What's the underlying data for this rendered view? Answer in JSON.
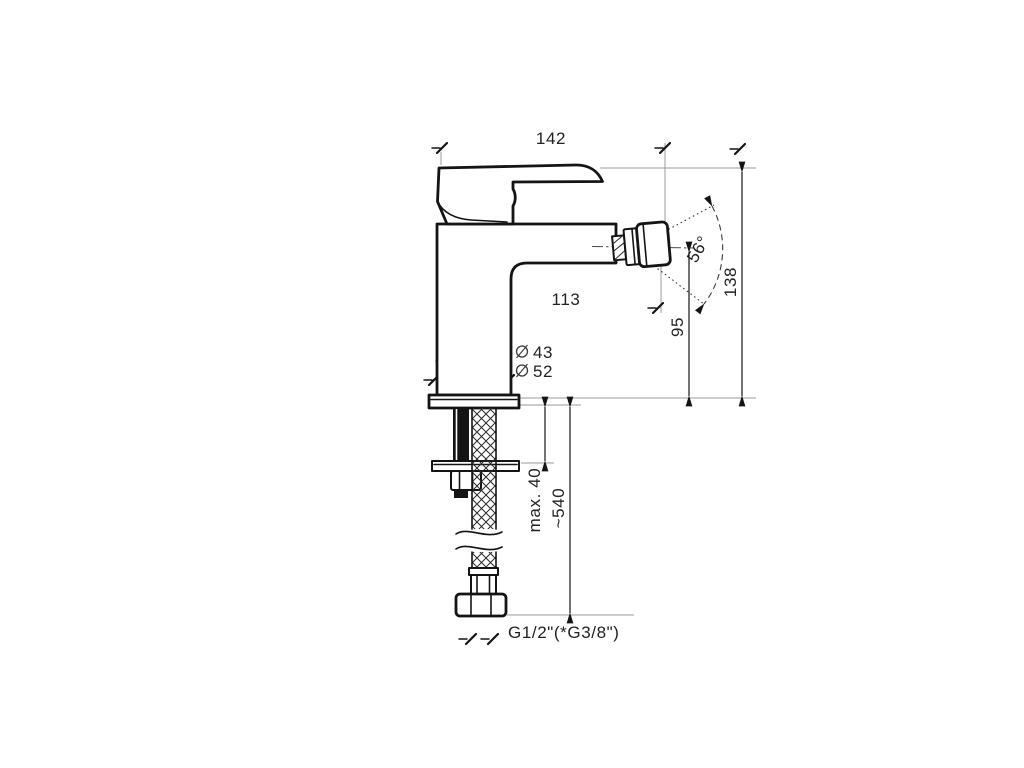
{
  "drawing": {
    "type": "technical dimension drawing",
    "subject": "single-lever bidet mixer faucet, side view, with mounting hardware and flexible supply hose",
    "background": "#ffffff",
    "colors": {
      "bg": "#ffffff",
      "line": "#141414",
      "ext": "#9b9b9b",
      "text": "#222222"
    },
    "dimensions": {
      "overall_width": "142",
      "spout_reach": "113",
      "spout_height": "95",
      "overall_height": "138",
      "swivel_angle": "56°",
      "body_dia": "43",
      "base_dia": "52",
      "deck_max": "max. 40",
      "hose_length": "~540",
      "thread": "G1/2\"(*G3/8\")"
    }
  }
}
